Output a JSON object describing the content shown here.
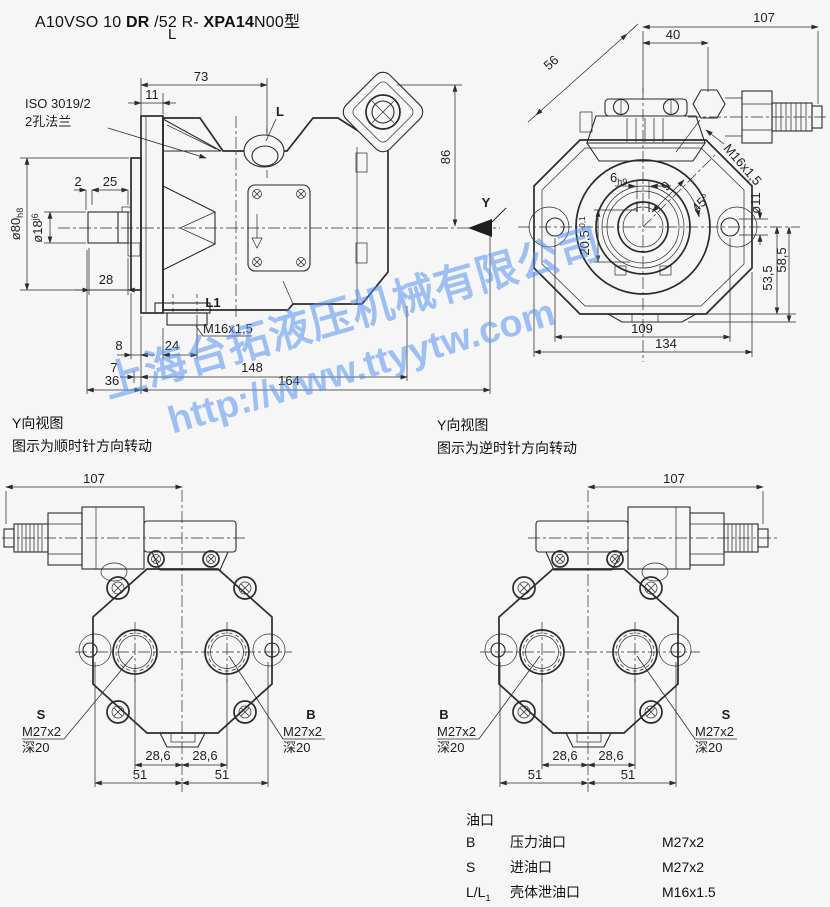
{
  "colors": {
    "background": "#f6f6f6",
    "line": "#2b2b2b",
    "watermark": "#5991f2"
  },
  "title": {
    "seg1": "A10VSO 10 ",
    "seg2": "DR",
    "seg3": " /52 R- ",
    "seg4": "XPA14",
    "seg5": "N00型",
    "sub": "L"
  },
  "side_view": {
    "iso_line1": "ISO 3019/2",
    "iso_line2": "2孔法兰",
    "dim_73": "73",
    "dim_11": "11",
    "port_l": "L",
    "dim_86": "86",
    "view_arrow": "Y",
    "dia_80": "ø80",
    "dia_80_tol": "h8",
    "dia_18": "ø18",
    "dia_18_tol": "j6",
    "dim_2": "2",
    "dim_25": "25",
    "dim_28": "28",
    "port_l1": "L1",
    "thread_l1": "M16x1,5",
    "dim_8": "8",
    "dim_24": "24",
    "dim_7": "7",
    "dim_148": "148",
    "dim_36": "36",
    "dim_164": "164"
  },
  "front_view": {
    "dim_107": "107",
    "dim_40": "40",
    "dim_56": "56",
    "thread_valve": "M16x1,5",
    "key_width": "6",
    "key_width_tol": "h9",
    "dim_9": "9",
    "angle_45": "45°",
    "key_depth": "20,5",
    "key_depth_tol": "-0,1",
    "dia_11": "ø11",
    "dim_53_5": "53,5",
    "dim_58_5": "58,5",
    "dim_109": "109",
    "dim_134": "134"
  },
  "cw_view": {
    "caption_line1": "Y向视图",
    "caption_line2": "图示为顺时针方向转动",
    "dim_107": "107",
    "port_left": "S",
    "port_right": "B",
    "thread_left": "M27x2",
    "depth_left": "深20",
    "thread_right": "M27x2",
    "depth_right": "深20",
    "dim_286_left": "28,6",
    "dim_286_right": "28,6",
    "dim_51_left": "51",
    "dim_51_right": "51"
  },
  "ccw_view": {
    "caption_line1": "Y向视图",
    "caption_line2": "图示为逆时针方向转动",
    "dim_107": "107",
    "port_left": "B",
    "port_right": "S",
    "thread_left": "M27x2",
    "depth_left": "深20",
    "thread_right": "M27x2",
    "depth_right": "深20",
    "dim_286_left": "28,6",
    "dim_286_right": "28,6",
    "dim_51_left": "51",
    "dim_51_right": "51"
  },
  "ports_table": {
    "title": "油口",
    "rows": [
      {
        "code": "B",
        "code_sub": "",
        "name": "压力油口",
        "size": "M27x2"
      },
      {
        "code": "S",
        "code_sub": "",
        "name": "进油口",
        "size": "M27x2"
      },
      {
        "code": "L/L",
        "code_sub": "1",
        "name": "壳体泄油口",
        "size": "M16x1.5"
      }
    ]
  },
  "watermark": {
    "line1": "上海台拓液压机械有限公司",
    "line2": "http://www.ttyytw.com"
  }
}
